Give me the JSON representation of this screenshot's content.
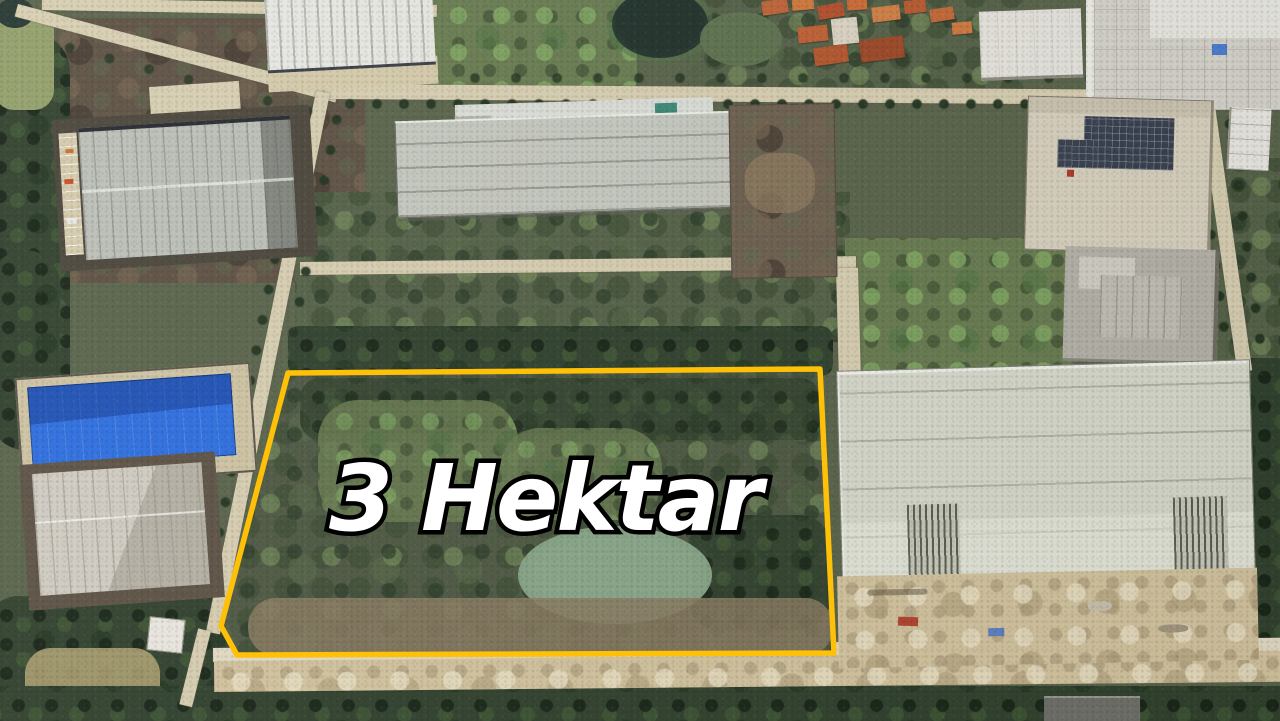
{
  "annotation": {
    "area_label": "3 Hektar",
    "outline_color": "#ffc107",
    "label_color": "#ffffff",
    "label_stroke_color": "#000000"
  }
}
